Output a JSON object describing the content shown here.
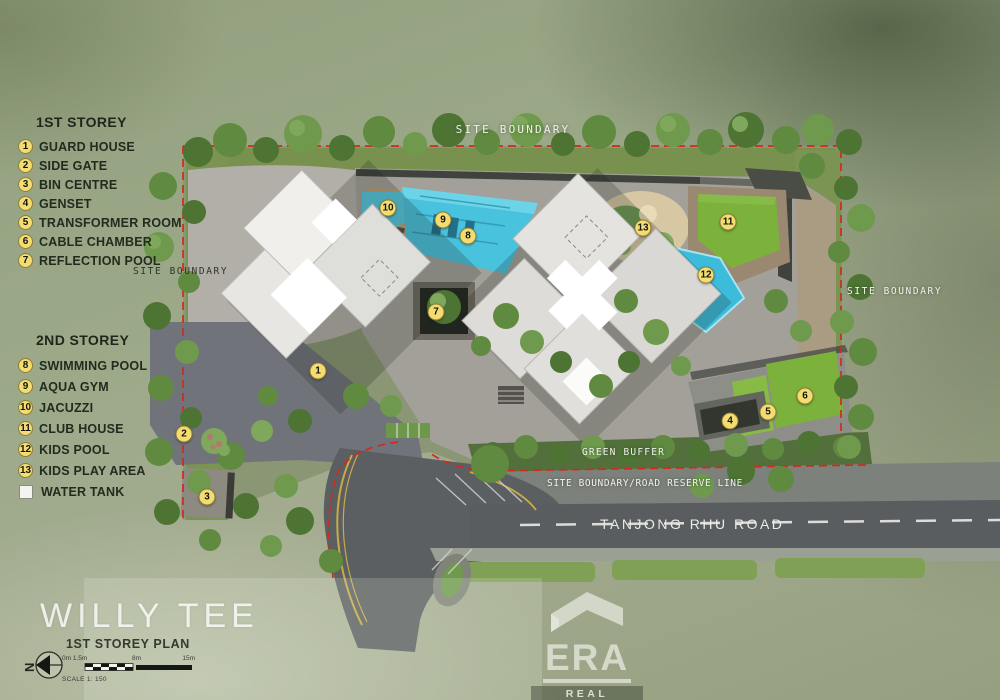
{
  "plan": {
    "title": "1ST STOREY PLAN",
    "watermark": "WILLY TEE",
    "scale_caption": "SCALE 1: 150",
    "scale_ticks": [
      "0m 1.5m",
      "8m",
      "15m"
    ],
    "compass_letter": "N",
    "marker_numbers": [
      "1",
      "2",
      "3",
      "4",
      "5",
      "6",
      "7",
      "8",
      "9",
      "10",
      "11",
      "12",
      "13"
    ],
    "labels": {
      "site_boundary_top": "SITE BOUNDARY",
      "site_boundary_left": "SITE BOUNDARY",
      "site_boundary_right": "SITE BOUNDARY",
      "green_buffer": "GREEN BUFFER",
      "road_reserve_line": "SITE BOUNDARY/ROAD RESERVE LINE",
      "road_name": "TANJONG RHU ROAD"
    }
  },
  "legend": {
    "first_storey": {
      "heading": "1ST STOREY",
      "items": [
        {
          "num": "1",
          "label": "GUARD HOUSE"
        },
        {
          "num": "2",
          "label": "SIDE GATE"
        },
        {
          "num": "3",
          "label": "BIN CENTRE"
        },
        {
          "num": "4",
          "label": "GENSET"
        },
        {
          "num": "5",
          "label": "TRANSFORMER ROOM"
        },
        {
          "num": "6",
          "label": "CABLE CHAMBER"
        },
        {
          "num": "7",
          "label": "REFLECTION POOL"
        }
      ]
    },
    "second_storey": {
      "heading": "2ND STOREY",
      "items": [
        {
          "num": "8",
          "label": "SWIMMING POOL"
        },
        {
          "num": "9",
          "label": "AQUA GYM"
        },
        {
          "num": "10",
          "label": "JACUZZI"
        },
        {
          "num": "11",
          "label": "CLUB HOUSE"
        },
        {
          "num": "12",
          "label": "KIDS POOL"
        },
        {
          "num": "13",
          "label": "KIDS PLAY AREA"
        }
      ],
      "water_tank_label": "WATER TANK"
    }
  },
  "logo": {
    "brand": "ERA",
    "subtitle": "REAL ESTATE"
  },
  "colors": {
    "boundary_red": "#cf2b1e",
    "marker_yellow": "#f3dd72",
    "pool_blue": "#49c2de",
    "lawn_green": "#7cb23c",
    "paving_gray": "#a3a09a",
    "road_gray": "#595d60",
    "background_green": "#9aa488"
  }
}
